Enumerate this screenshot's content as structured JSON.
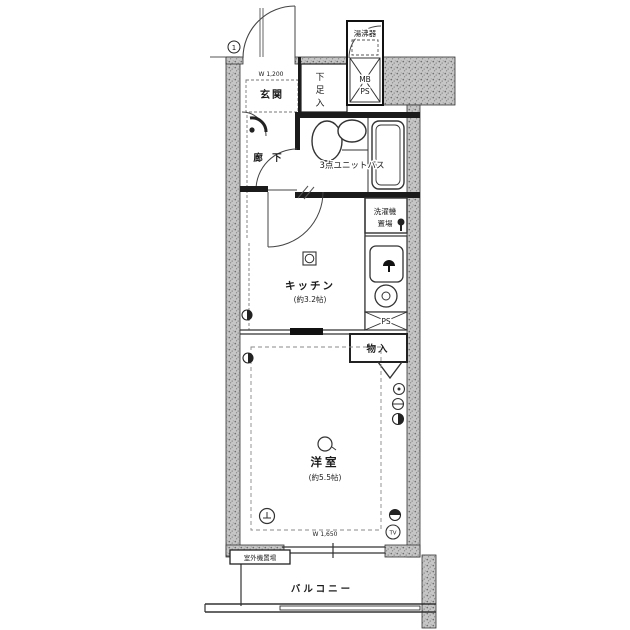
{
  "floorplan": {
    "unit_marker": "1",
    "labels": {
      "entrance": "玄関",
      "shoe1": "下",
      "shoe2": "足",
      "shoe3": "入",
      "water_heater": "湯沸器",
      "mb": "MB",
      "mb_ps": "PS",
      "unit_bath": "3点ユニットバス",
      "hallway": "廊 下",
      "washer1": "洗濯機",
      "washer2": "置場",
      "kitchen": "キッチン",
      "kitchen_size": "(約3.2帖)",
      "ps": "PS",
      "closet": "物入",
      "room": "洋室",
      "room_size": "(約5.5帖)",
      "balcony": "バルコニー",
      "tv": "TV",
      "outdoor_unit": "室外機置場",
      "dim_entrance": "W 1,200",
      "dim_window": "W 1,650"
    },
    "colors": {
      "line": "#1b1b1b",
      "wall_fill": "#c4c4c4",
      "background": "#ffffff"
    }
  }
}
